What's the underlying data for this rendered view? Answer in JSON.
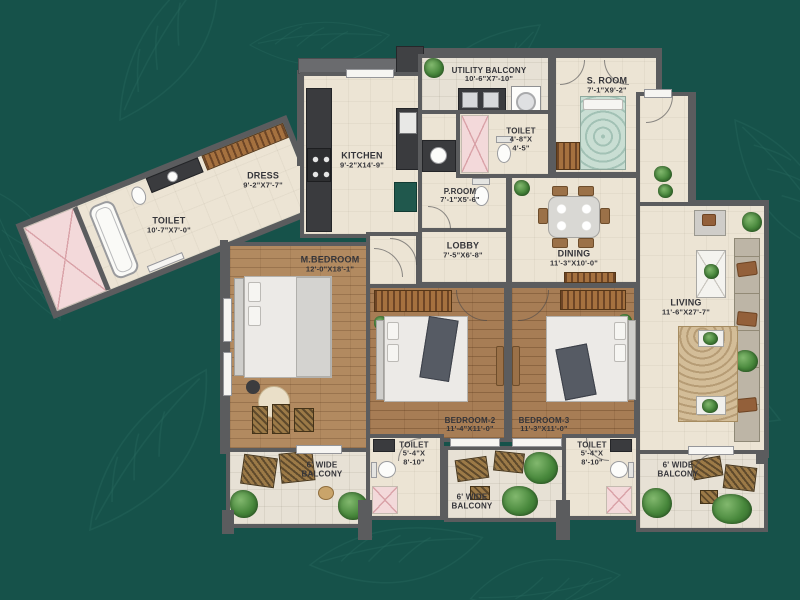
{
  "plan_title": "3 BHK floor plan",
  "palette": {
    "background_teal": "#16524a",
    "wall_gray": "#5b5c5e",
    "floor_cream": "#ece4d4",
    "wood_brown": "#a77d55",
    "shaft_pink": "#f3d9da",
    "kitchen_teal_unit": "#20584d",
    "plant_green": "#47873b"
  },
  "rooms": {
    "utility_balcony": {
      "name": "UTILITY BALCONY",
      "dims": "10'-6\"X7'-10\""
    },
    "s_room": {
      "name": "S. ROOM",
      "dims": "7'-1\"X9'-2\""
    },
    "kitchen": {
      "name": "KITCHEN",
      "dims": "9'-2\"X14'-9\""
    },
    "toilet_top": {
      "name": "TOILET",
      "dims_line1": "4'-8\"X",
      "dims_line2": "4'-5\""
    },
    "p_room": {
      "name": "P.ROOM",
      "dims": "7'-1\"X5'-6\""
    },
    "wing_toilet": {
      "name": "TOILET",
      "dims": "10'-7\"X7'-0\""
    },
    "dress": {
      "name": "DRESS",
      "dims": "9'-2\"X7'-7\""
    },
    "lobby": {
      "name": "LOBBY",
      "dims": "7'-5\"X6'-8\""
    },
    "dining": {
      "name": "DINING",
      "dims": "11'-3\"X10'-0\""
    },
    "living": {
      "name": "LIVING",
      "dims": "11'-6\"X27'-7\""
    },
    "m_bedroom": {
      "name": "M.BEDROOM",
      "dims": "12'-0\"X18'-1\""
    },
    "bedroom2": {
      "name": "BEDROOM-2",
      "dims": "11'-4\"X11'-0\""
    },
    "bedroom3": {
      "name": "BEDROOM-3",
      "dims": "11'-3\"X11'-0\""
    },
    "toilet_b2": {
      "name": "TOILET",
      "dims_line1": "5'-4\"X",
      "dims_line2": "8'-10\""
    },
    "toilet_b3": {
      "name": "TOILET",
      "dims_line1": "5'-4\"X",
      "dims_line2": "8'-10\""
    },
    "balcony_left": {
      "line1": "6' WIDE",
      "line2": "BALCONY"
    },
    "balcony_mid": {
      "line1": "6' WIDE",
      "line2": "BALCONY"
    },
    "balcony_right": {
      "line1": "6' WIDE",
      "line2": "BALCONY"
    }
  }
}
